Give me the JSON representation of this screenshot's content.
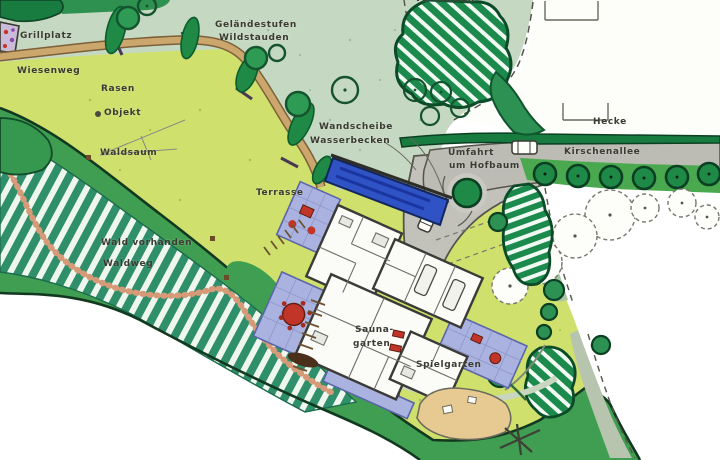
{
  "plan": {
    "type": "hand-drawn landscape garden site plan",
    "language": "de",
    "labels": {
      "grillplatz": "Grillplatz",
      "wiesenweg": "Wiesenweg",
      "rasen": "Rasen",
      "objekt": "Objekt",
      "waldsaum": "Waldsaum",
      "gelaendestufen_line1": "Geländestufen",
      "gelaendestufen_line2": "Wildstauden",
      "wald_vorhanden": "Wald vorhanden",
      "waldweg": "Waldweg",
      "wandscheibe": "Wandscheibe",
      "wasserbecken": "Wasserbecken",
      "terrasse": "Terrasse",
      "vorhanden_top": "vorhanden",
      "hecke": "Hecke",
      "umfahrt_line1": "Umfahrt",
      "umfahrt_line2": "um Hofbaum",
      "kirschenallee": "Kirschenallee",
      "sauna_line1": "Sauna-",
      "sauna_line2": "garten",
      "spielgarten": "Spielgarten"
    },
    "colors": {
      "background_meadow": "#c5d8c2",
      "lawn": "#cfe06d",
      "forest_edge": "#3f9e51",
      "forest_hatch": "#2f8f6b",
      "hedge_dark": "#187c40",
      "road_gray": "#bcbcb5",
      "terrace_paving": "#aab3e0",
      "water_basin": "#2f52c5",
      "meadow_path": "#cba76e",
      "forest_path": "#d79a78",
      "sand": "#e6ca92",
      "furniture_red": "#c03527",
      "label_text": "#3b3b31"
    }
  }
}
